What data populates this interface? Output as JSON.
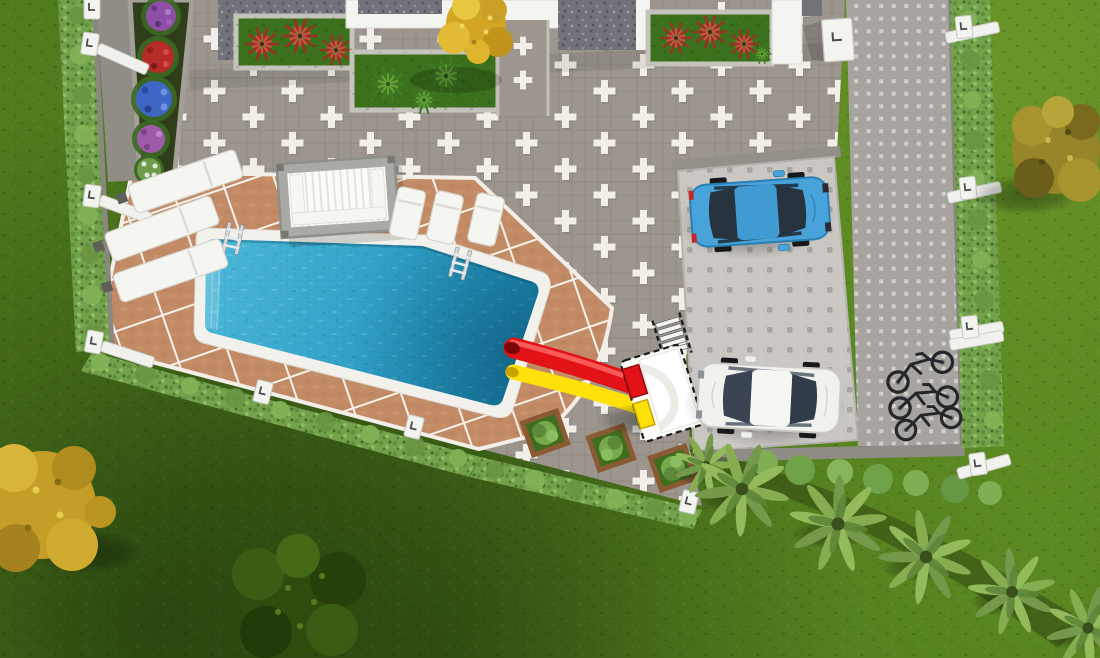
{
  "scene": {
    "kind": "aerial-3d-architectural-render",
    "view": "top-down"
  },
  "colors": {
    "grass_base": "#507c1d",
    "courtyard_tile": "#9c968e",
    "tile_accent": "#f2efe9",
    "deck_tile": "#c28b66",
    "deck_grout": "#f5f1ea",
    "pool_coping": "#f2f1ec",
    "pool_water_shallow": "#4cb9da",
    "pool_water_deep": "#1881ad",
    "hedge_green": "#74a24c",
    "flowerbed_soil": "#2f3d1a",
    "flower_red": "#b52b28",
    "flower_blue": "#3f66c4",
    "flower_purple": "#8d4fa8",
    "flower_pink": "#a05ba8",
    "flower_white": "#e2eadf",
    "slide_red": "#e21216",
    "slide_yellow": "#ffe10a",
    "slide_tower_white": "#fbfbf8",
    "car_blue": "#47a3d9",
    "car_white": "#f1f1ee",
    "glass_dark": "#283340",
    "parking_pad": "#cac7c3",
    "pad_dot": "#a8a5a1",
    "driveway": "#a7a39e",
    "driveway_dot": "#d9d6d2",
    "curb_gray": "#8f8c86",
    "roof_gravel": "#72727a",
    "parapet_white": "#f4f4f1",
    "planter_grass": "#3b701c",
    "fern_red": "#9e2f24",
    "fern_green": "#3f7a24",
    "planter_wood": "#8a5a33",
    "bush_green": "#77a94d",
    "palm_frond": "#86ad4f",
    "tree_yellow": "#d2a524",
    "tree_olive": "#97852a",
    "tree_dark_green": "#2f4c0e",
    "post_white": "#f3f3f0",
    "ladder_chrome": "#d7dadd",
    "bike_dark": "#24262a"
  },
  "inventory": {
    "cars": 2,
    "bicycles": 3,
    "sun_loungers": 6,
    "water_slides": 2,
    "pool_ladders": 2,
    "wooden_planters": 3,
    "building_planters": 3,
    "flower_clusters": 5,
    "palm_trees": 6,
    "fence_posts": 11,
    "gate_pillars": 1,
    "pergolas": 1,
    "pools": 1
  }
}
